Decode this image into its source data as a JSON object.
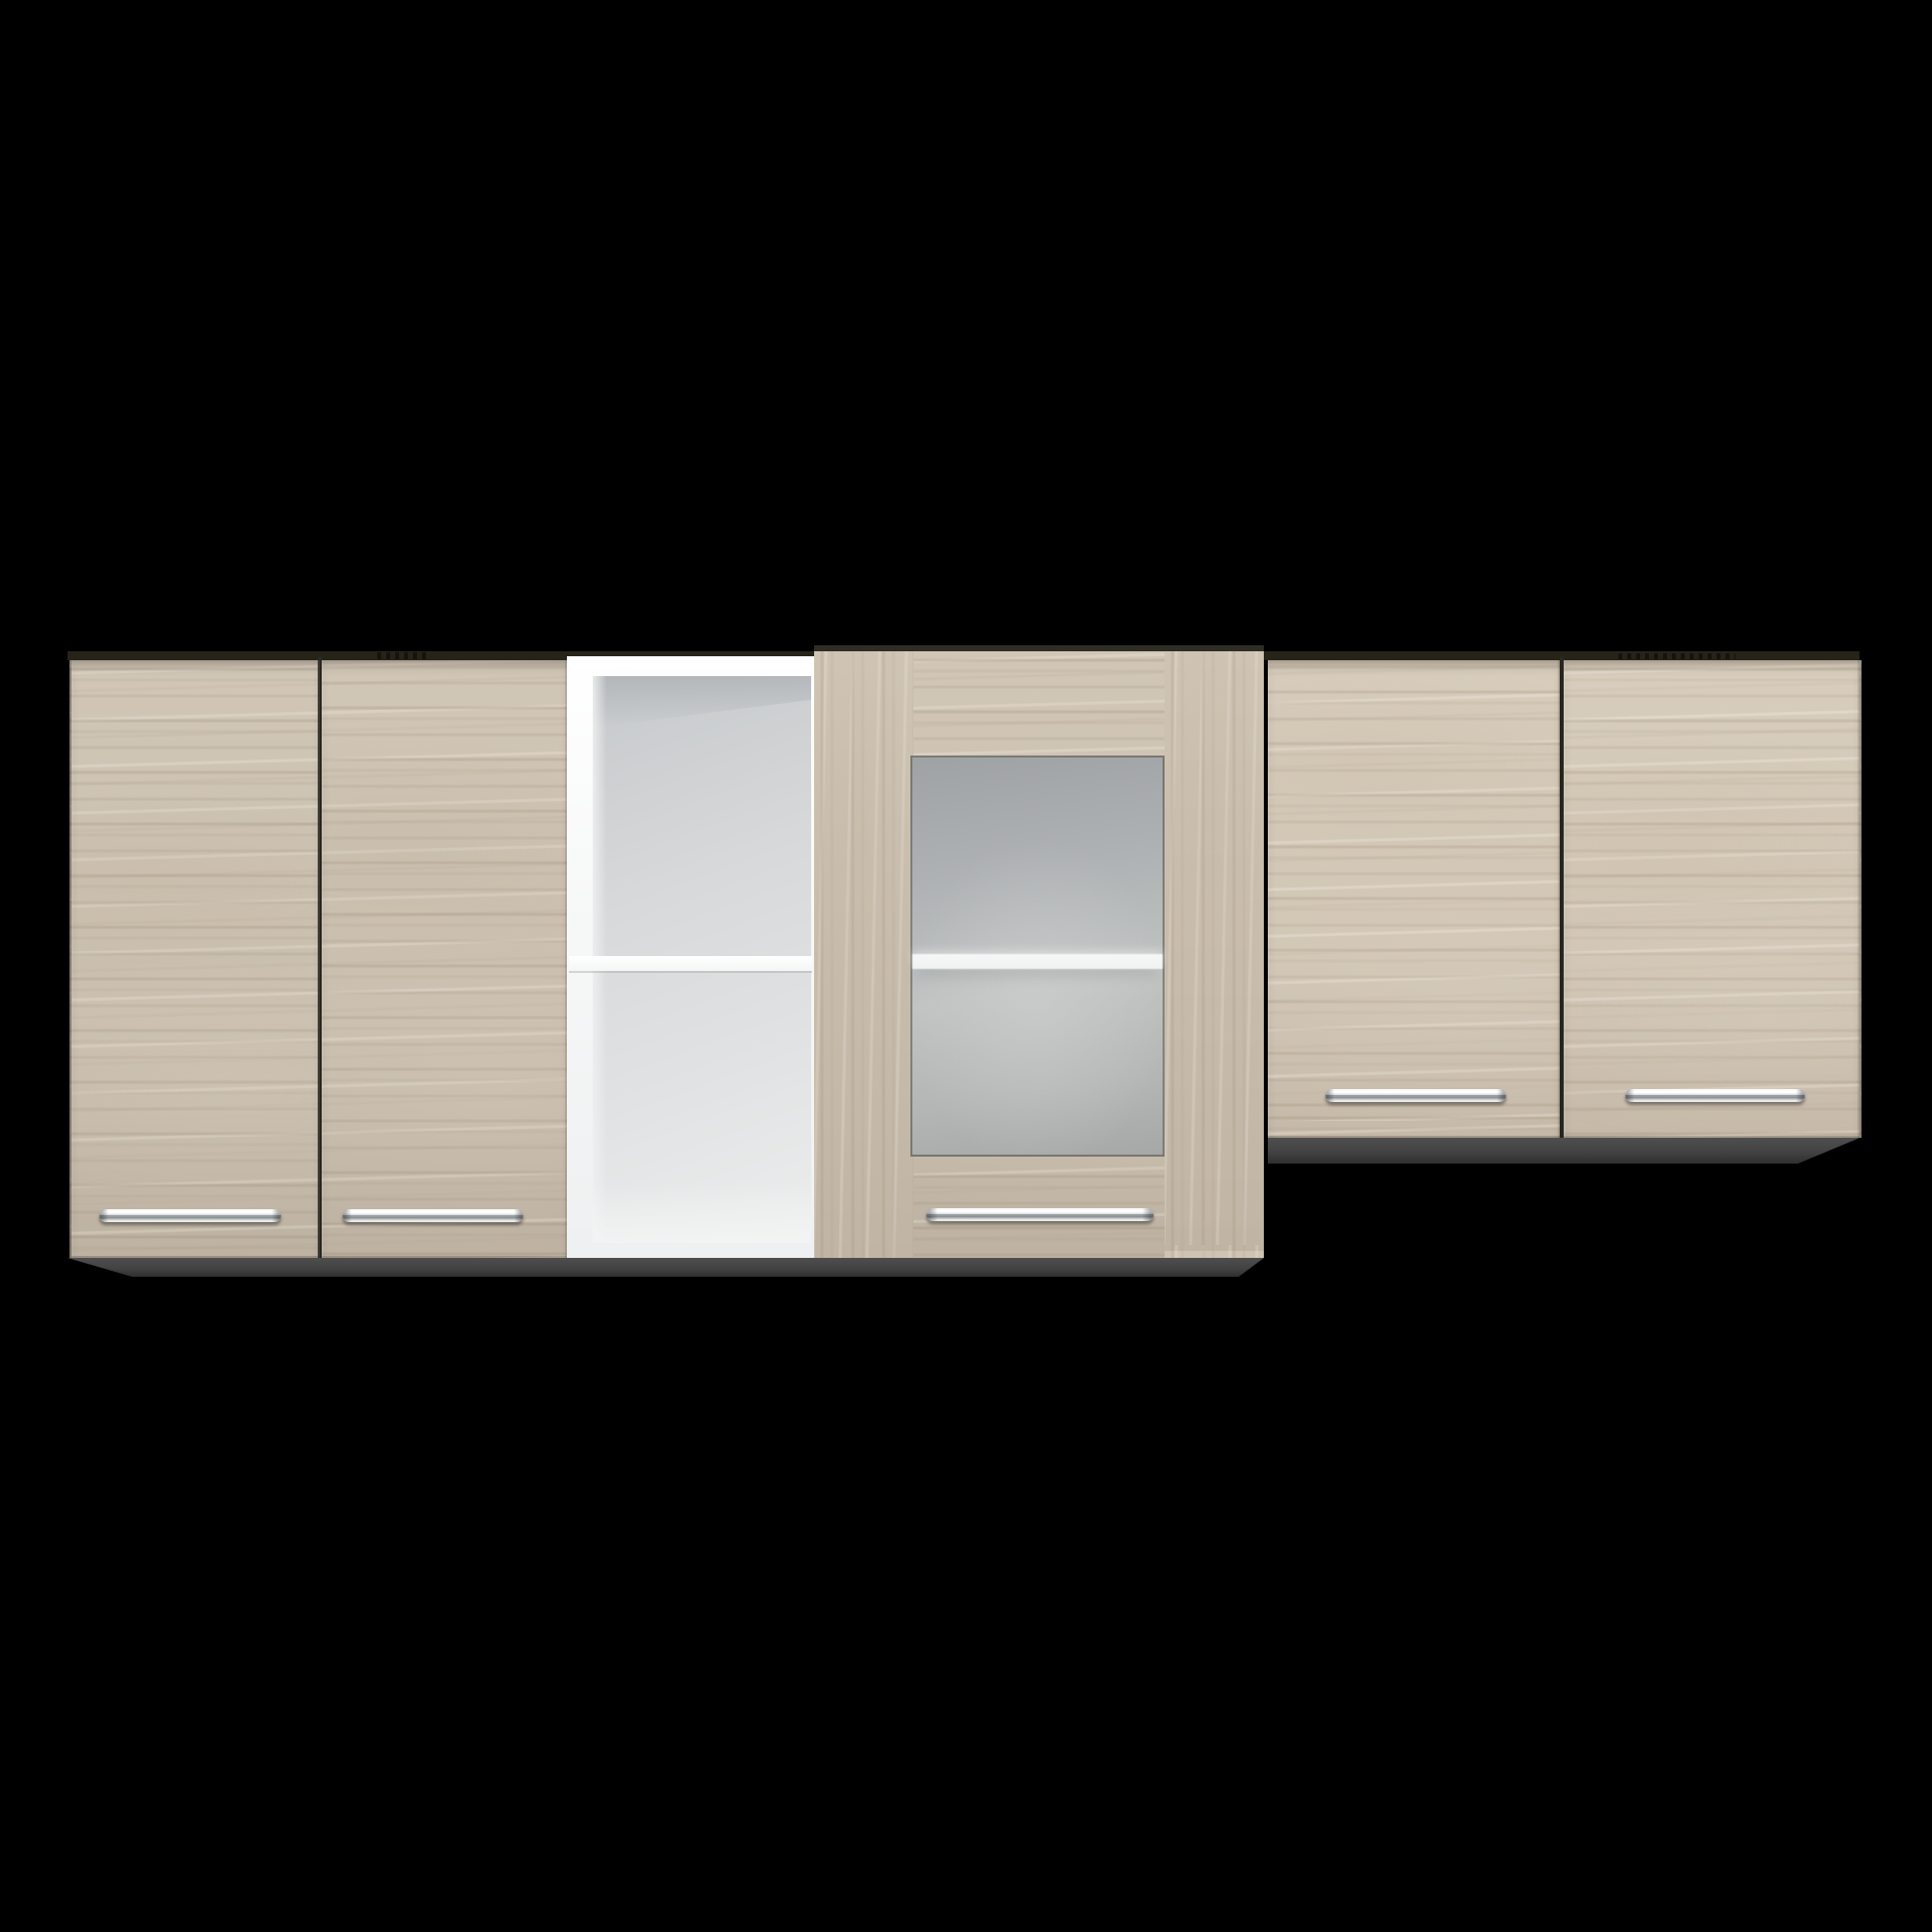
{
  "scene": {
    "description": "Product photo of a light-wood kitchen wall cabinet set with chrome bar handles, an open white shelf module and a frosted-glass door, floating on a solid black background",
    "background": "black"
  },
  "cabinet": {
    "finish": "light oak / larch laminate",
    "sections": [
      {
        "name": "left two-door cabinet",
        "doors": 2,
        "handles": 2,
        "handle_style": "chrome bar"
      },
      {
        "name": "open shelf module",
        "compartments": 2,
        "interior_color": "white"
      },
      {
        "name": "glass door cabinet",
        "doors": 1,
        "glass": "frosted",
        "visible_shelves": 1,
        "handles": 1
      },
      {
        "name": "right two-door cabinet (shorter)",
        "doors": 2,
        "handles": 2,
        "handle_style": "chrome bar"
      }
    ],
    "total_door_count": 5,
    "total_handle_count": 5,
    "hinge_marks_visible": 2
  },
  "colors": {
    "background": "#000000",
    "wood_base": "#cec3b2",
    "wood_streak_dark": "#b7aa97",
    "wood_streak_light": "#efe9df",
    "top_edge": "#262419",
    "gap_line": "#2e2c26",
    "underside": "#434343",
    "underside_dark": "#2f2f2f",
    "shelf_frame": "#f7f8f8",
    "interior_light": "#eceeee",
    "interior_mid": "#d7d9da",
    "interior_dark": "#c6c9cb",
    "glass_top": "#9fa2a4",
    "glass_mid": "#c0c3c2",
    "glass_bottom": "#a5a8a7",
    "glass_shelf": "#f0f2f2",
    "chrome_hi": "#ffffff",
    "chrome_mid": "#989da0",
    "chrome_lo": "#e7e9ea",
    "hinge": "#14130e"
  }
}
